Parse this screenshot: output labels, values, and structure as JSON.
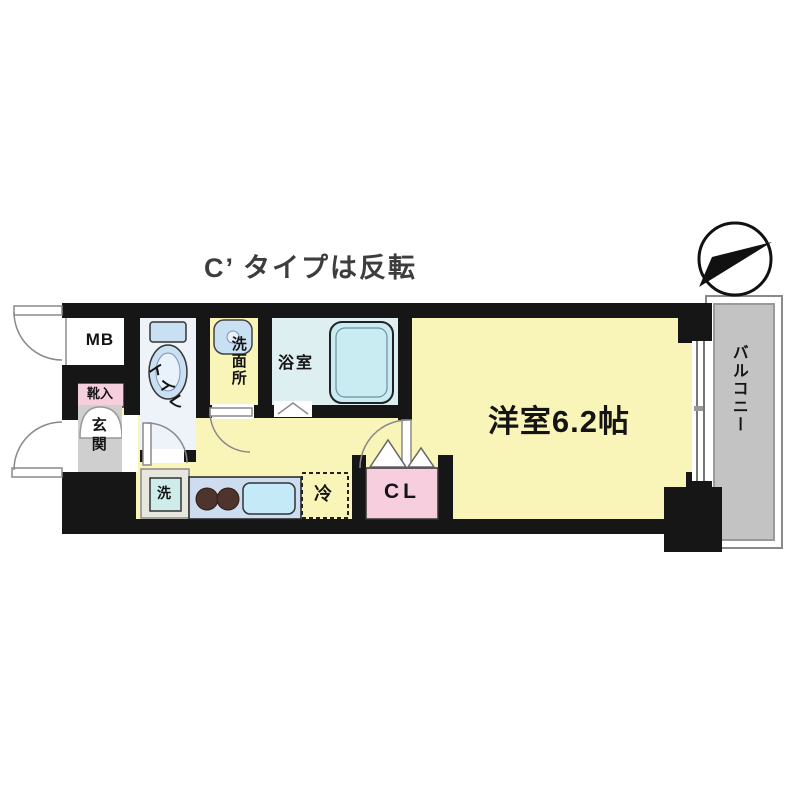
{
  "title": "C’ タイプは反転",
  "compass": {
    "icon": "north-arrow"
  },
  "rooms": {
    "mb": "MB",
    "shoe_cabinet": "靴入",
    "entrance": "玄関",
    "toilet": "トイレ",
    "washroom": "洗面所",
    "bathroom": "浴室",
    "washer": "洗",
    "fridge": "冷",
    "closet": "CL",
    "main_room": "洋室6.2帖",
    "balcony": "バルコニー"
  },
  "colors": {
    "wall": "#161616",
    "floor_yellow": "#f9f5b9",
    "bath_floor": "#ddeff0",
    "toilet_floor": "#eef2f9",
    "pink": "#f6cede",
    "entrance_gray": "#cfcfcf",
    "balcony_gray": "#c3c3c3",
    "counter_blue": "#cdddef",
    "fixture_blue": "#c9e0f2",
    "tub_blue": "#c9ecf2",
    "sink_blue": "#c4e9f7",
    "washer_blue": "#cdecea",
    "burner_brown": "#4e342c",
    "title_text": "#3d3d3d"
  }
}
